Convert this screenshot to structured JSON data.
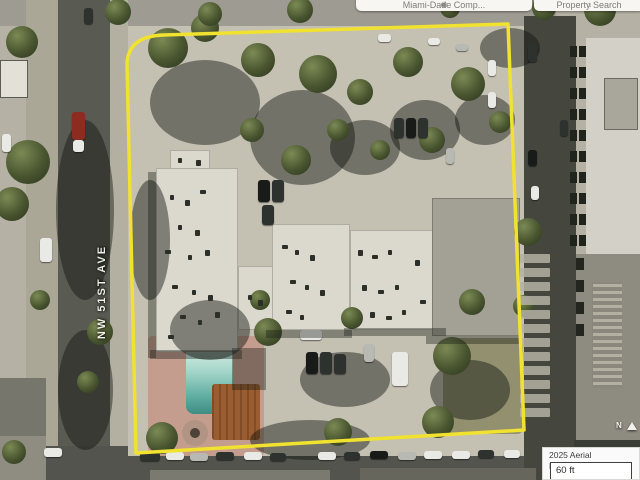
{
  "toolbar": {
    "left_tab_label": "Miami-Dade Comp...",
    "right_tab_label": "Property Search"
  },
  "map": {
    "street_label": "NW 51ST AVE",
    "north_label": "N",
    "boundary_color": "#f1e22f"
  },
  "attribution": {
    "text": "2025 Aerial Photography",
    "scale_label": "60 ft"
  }
}
